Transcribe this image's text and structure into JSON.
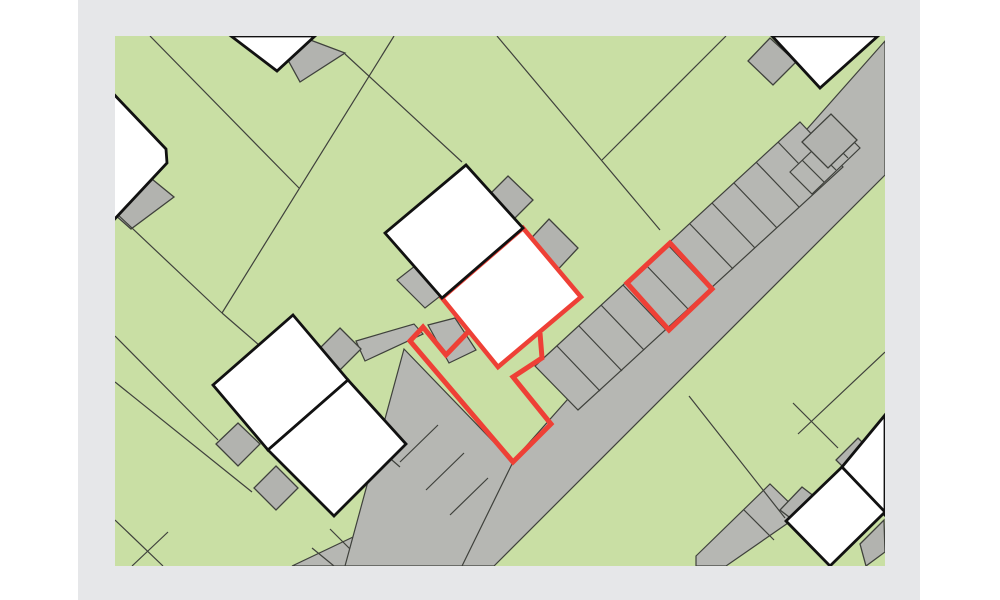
{
  "page": {
    "background": "#ffffff",
    "panel": {
      "x": 78,
      "y": 0,
      "width": 842,
      "height": 600,
      "color": "#e6e7e9"
    }
  },
  "map": {
    "x": 115,
    "y": 36,
    "width": 770,
    "height": 530,
    "colors": {
      "land": "#c9dfa4",
      "road": "#b6b7b3",
      "shed": "#b2b3af",
      "thin_line": "#3f413c",
      "building_fill": "#ffffff",
      "building_stroke": "#111111",
      "highlight": "#ee4036"
    },
    "stroke_widths": {
      "thin_line": 1.2,
      "divider": 1.1,
      "shed": 1.3,
      "building": 2.8,
      "highlight_building": 4.5,
      "highlight_parcel": 5
    },
    "road": {
      "main": "885,41 885,175 494,566 292,566 513,461",
      "bottom_dividers": [
        [
          312,
          548,
          334,
          566
        ],
        [
          330,
          529,
          354,
          553
        ]
      ]
    },
    "parking_strips": [
      {
        "name": "parking-strip-along-road",
        "outline": "535,366 800,122 843,167 578,410",
        "dividers": [
          [
            557,
            346,
            600,
            391
          ],
          [
            579,
            326,
            622,
            371
          ],
          [
            601,
            305,
            644,
            350
          ],
          [
            623,
            285,
            666,
            330
          ],
          [
            645,
            264,
            688,
            309
          ],
          [
            667,
            244,
            710,
            289
          ],
          [
            690,
            224,
            733,
            269
          ],
          [
            712,
            203,
            755,
            248
          ],
          [
            734,
            183,
            777,
            228
          ],
          [
            756,
            162,
            799,
            207
          ],
          [
            778,
            142,
            821,
            187
          ]
        ]
      },
      {
        "name": "driveway-strip-southwest",
        "outline": "404,349 513,462 462,566 345,566",
        "dividers": [
          [
            438,
            425,
            400,
            462
          ],
          [
            464,
            453,
            426,
            490
          ],
          [
            488,
            478,
            450,
            515
          ]
        ]
      },
      {
        "name": "parking-strip-northeast",
        "outline": "790,172 838,126 860,148 812,194",
        "dividers": [
          [
            802,
            160,
            824,
            182
          ],
          [
            814,
            148,
            836,
            170
          ],
          [
            826,
            136,
            848,
            158
          ]
        ]
      },
      {
        "name": "garage-row-bottom-right",
        "outline": "696,556 770,484 801,514 726,566 696,566",
        "dividers": [
          [
            744,
            510,
            774,
            540
          ]
        ]
      }
    ],
    "footpaths": [
      {
        "name": "footpath-west",
        "points": "356,341 414,324 423,334 365,361"
      },
      {
        "name": "footpath-center",
        "points": "428,325 455,318 476,350 449,363"
      },
      {
        "name": "footpath-house-access",
        "points": "397,280 420,262 448,290 425,308"
      }
    ],
    "sheds": [
      {
        "name": "shed-topleft-house",
        "points": "147,175 174,197 131,229 105,206"
      },
      {
        "name": "shed-topcenter-house",
        "points": "305,38 345,53 300,82 288,60"
      },
      {
        "name": "shed-topright-house",
        "points": "770,38 796,62 773,85 748,61"
      },
      {
        "name": "garage-topright",
        "points": "802,142 831,114 857,140 828,168"
      },
      {
        "name": "shed-center-house-north",
        "points": "508,176 533,200 510,223 485,199"
      },
      {
        "name": "shed-center-house-east",
        "points": "549,219 578,248 551,277 522,248"
      },
      {
        "name": "shed-west-duplex-north",
        "points": "340,328 361,349 340,370 319,349"
      },
      {
        "name": "shed-west-duplex-west",
        "points": "238,423 260,444 238,466 216,444"
      },
      {
        "name": "shed-west-duplex-south",
        "points": "276,466 298,488 276,510 254,488"
      },
      {
        "name": "shed-bottomright-a",
        "points": "802,487 832,510 810,533 780,510"
      },
      {
        "name": "shed-bottomright-b",
        "points": "858,438 882,462 860,484 836,460"
      },
      {
        "name": "shed-bottomright-corner",
        "points": "860,544 884,520 885,552 866,566"
      }
    ],
    "parcel_lines": [
      [
        150,
        36,
        299,
        188
      ],
      [
        394,
        36,
        222,
        313
      ],
      [
        115,
        212,
        222,
        313
      ],
      [
        222,
        313,
        400,
        467
      ],
      [
        115,
        336,
        218,
        440
      ],
      [
        115,
        382,
        252,
        492
      ],
      [
        345,
        54,
        462,
        162
      ],
      [
        497,
        36,
        660,
        230
      ],
      [
        726,
        36,
        602,
        160
      ],
      [
        689,
        396,
        785,
        518
      ],
      [
        793,
        403,
        838,
        448
      ],
      [
        885,
        352,
        798,
        434
      ],
      [
        115,
        520,
        163,
        566
      ],
      [
        132,
        566,
        168,
        532
      ]
    ],
    "buildings": [
      {
        "name": "building-topleft",
        "points": "106,86 166,149 167,163 110,224 55,168"
      },
      {
        "name": "building-topcenter",
        "points": "231,36 277,71 315,36"
      },
      {
        "name": "building-topright",
        "points": "772,36 820,88 878,36"
      },
      {
        "name": "building-center-duplex-north",
        "points": "466,165 523,228 442,298 385,233"
      },
      {
        "name": "building-west-duplex-north",
        "points": "293,315 348,380 268,450 213,385"
      },
      {
        "name": "building-west-duplex-south",
        "points": "348,380 406,444 334,516 268,450"
      },
      {
        "name": "building-bottomright-a",
        "points": "885,415 885,515 842,467"
      },
      {
        "name": "building-bottomright-b",
        "points": "842,467 885,512 830,566 786,521"
      }
    ],
    "highlight": {
      "building": {
        "name": "highlighted-building",
        "points": "523,228 581,297 498,367 442,298"
      },
      "parcel_path": "M540,333 L542,358 L513,377 L551,424 L513,462 L410,341 L423,327 L446,355 L469,331",
      "parking_spaces": {
        "name": "highlighted-parking-spaces",
        "points": "627,283 670,243 712,289 669,330"
      }
    }
  }
}
